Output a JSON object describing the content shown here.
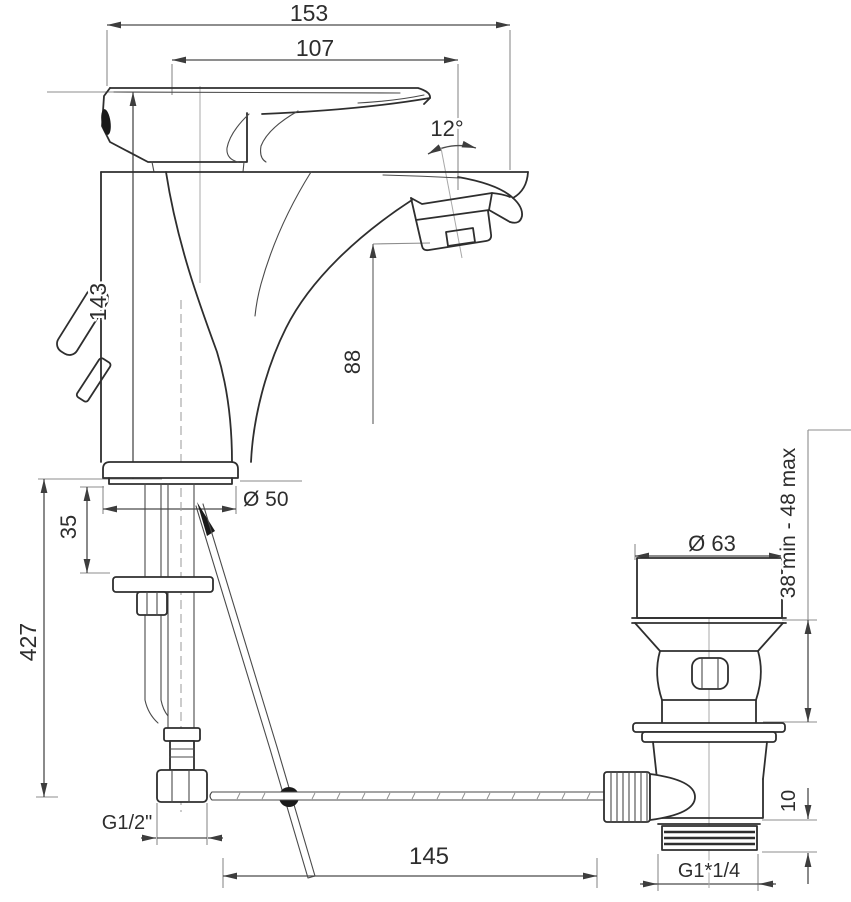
{
  "drawing": {
    "background": "#ffffff",
    "line_color": "#2e2e2e",
    "dimensions": {
      "overall_width": "153",
      "spout_reach": "107",
      "aerator_angle": "12°",
      "body_height": "143",
      "spout_outlet_height": "88",
      "deck_clearance": "35",
      "hose_drop_length": "427",
      "base_diameter": "Ø 50",
      "supply_thread": "G1/2\"",
      "rod_length": "145",
      "waste_cap_diameter": "Ø 63",
      "waste_mount_range": "38 min - 48 max",
      "waste_tail_height": "10",
      "waste_thread": "G1*1/4"
    }
  }
}
